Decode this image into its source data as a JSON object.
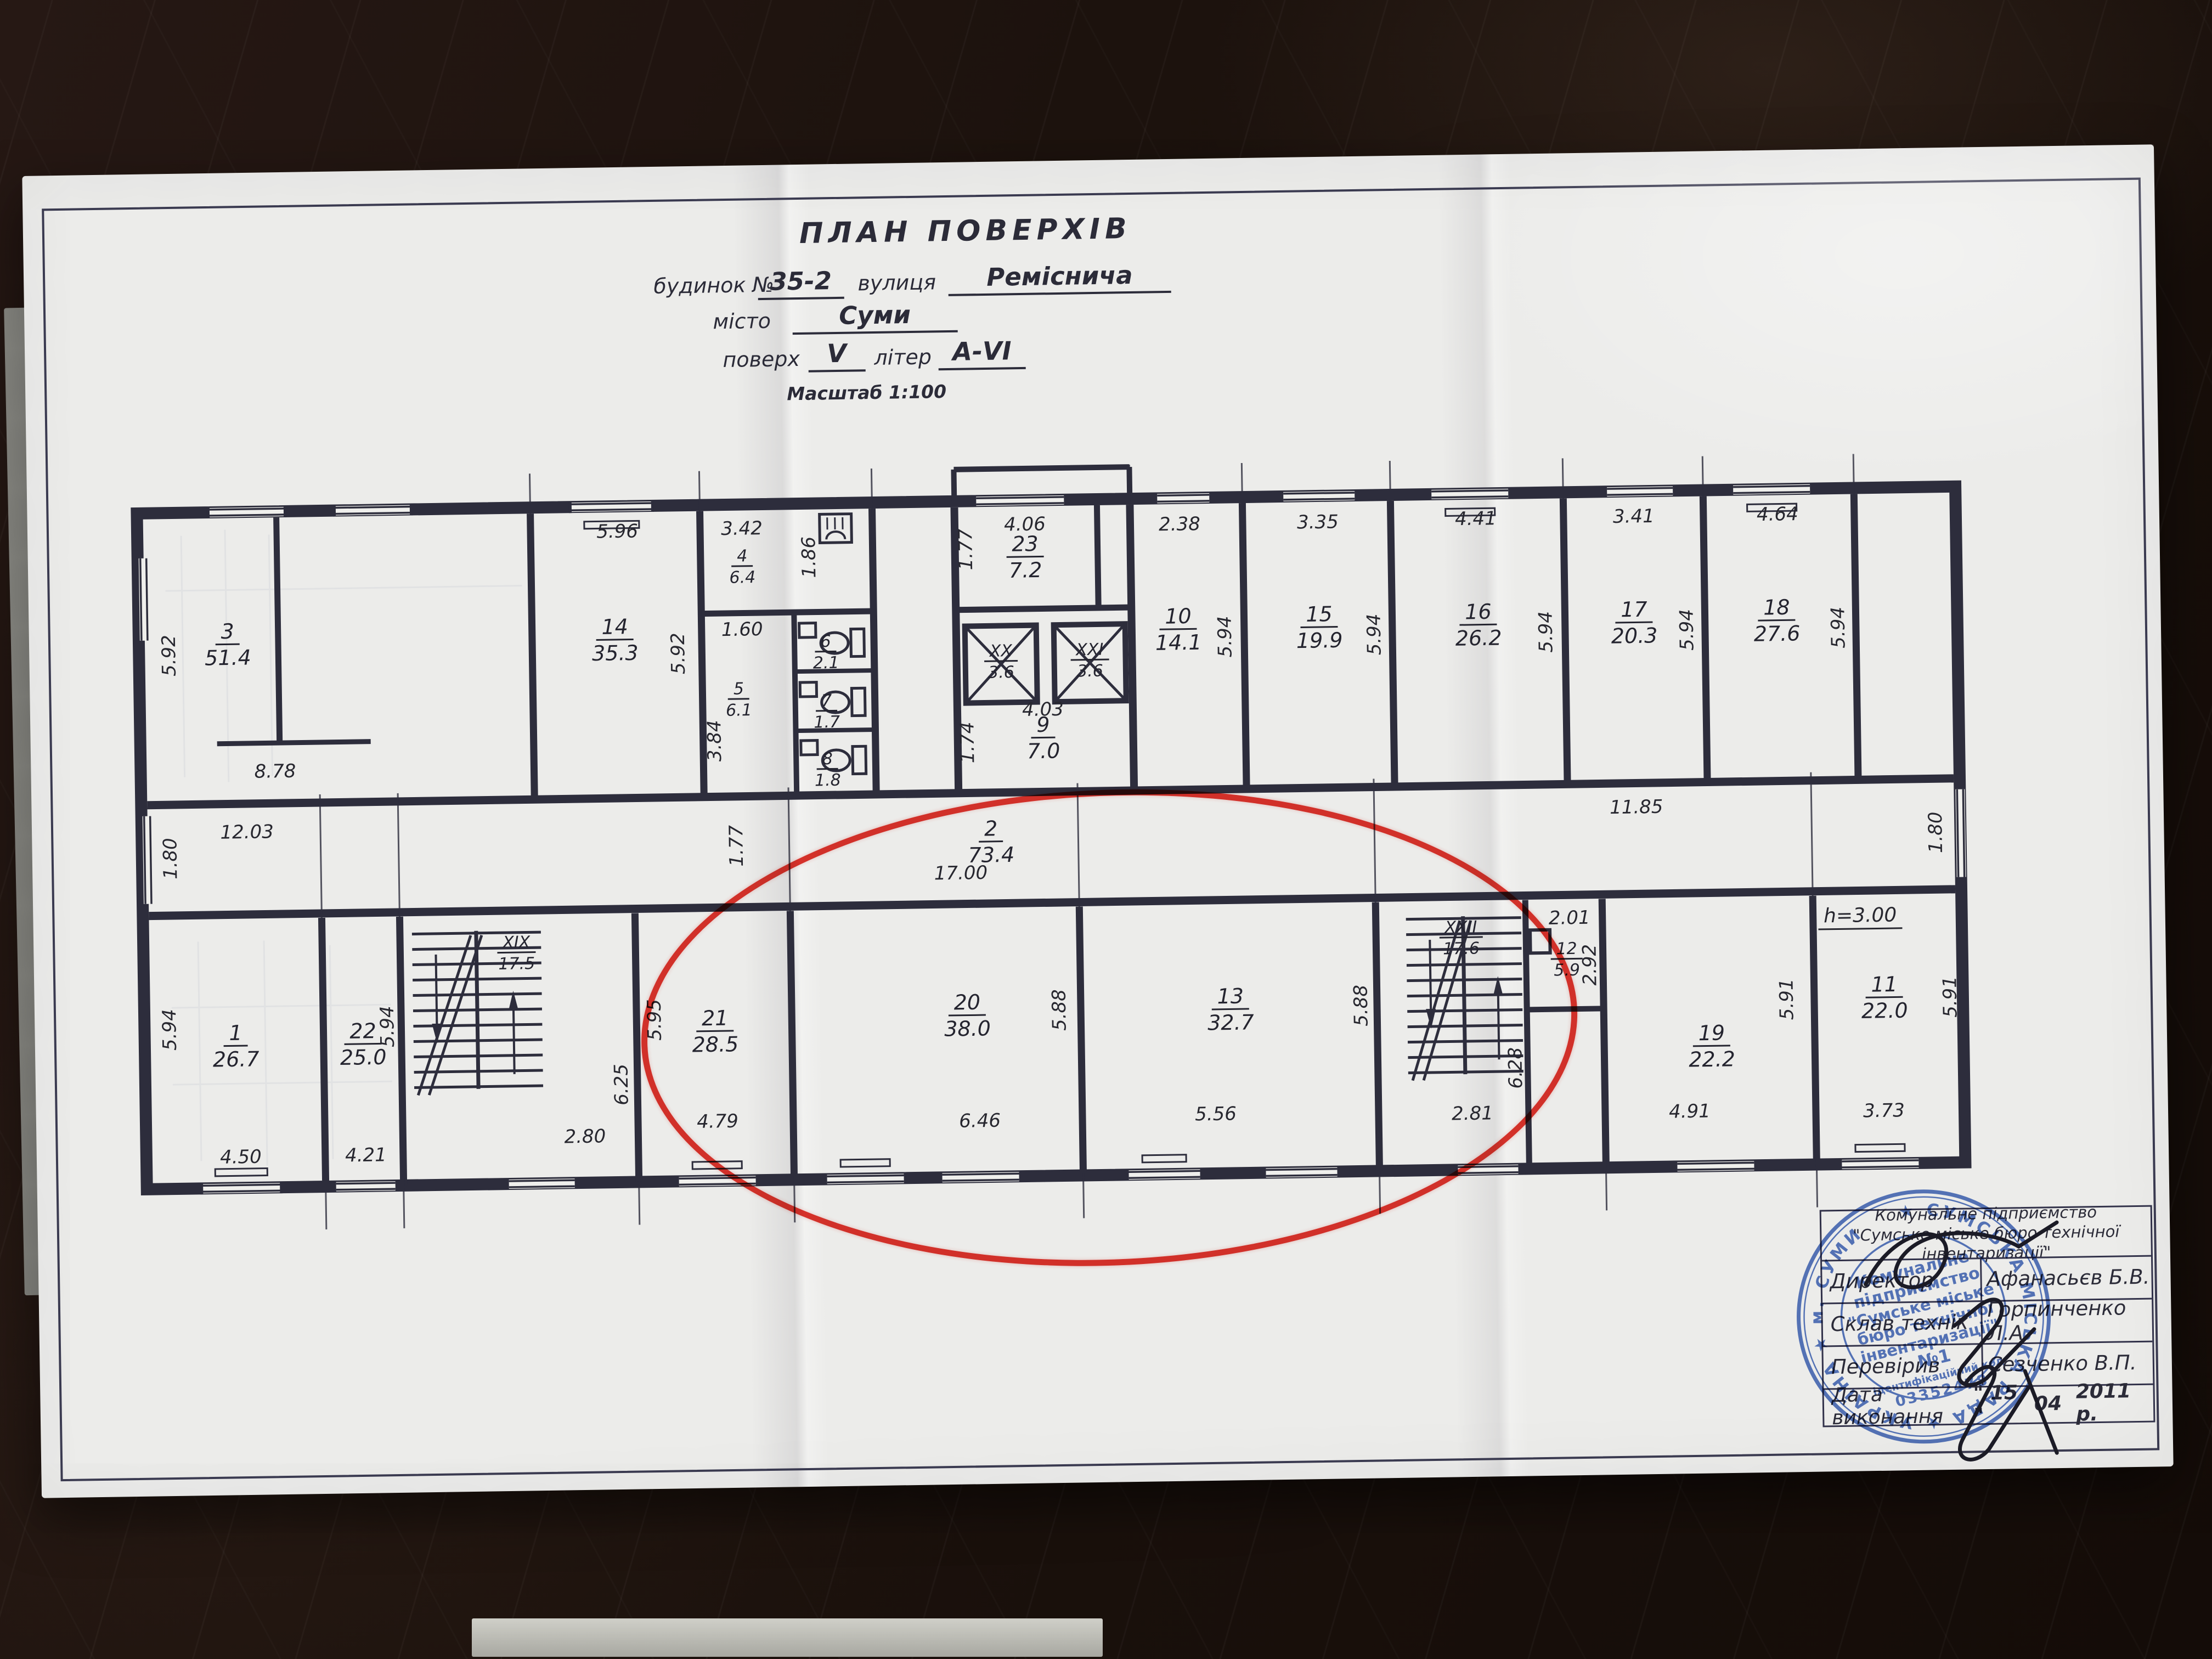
{
  "title_block": {
    "title": "ПЛАН ПОВЕРХІВ",
    "building_label": "будинок №",
    "building_value": "35-2",
    "street_label": "вулиця",
    "street_value": "Реміснича",
    "city_label": "місто",
    "city_value": "Суми",
    "floor_label": "поверх",
    "floor_value": "V",
    "letter_label": "літер",
    "letter_value": "А-VI",
    "scale_label": "Масштаб 1:100"
  },
  "plan": {
    "rooms": [
      {
        "num": "3",
        "area": "51.4"
      },
      {
        "num": "14",
        "area": "35.3"
      },
      {
        "num": "4",
        "area": "6.4"
      },
      {
        "num": "5",
        "area": "6.1"
      },
      {
        "num": "6",
        "area": "2.1"
      },
      {
        "num": "7",
        "area": "1.7"
      },
      {
        "num": "8",
        "area": "1.8"
      },
      {
        "num": "23",
        "area": "7.2"
      },
      {
        "num": "XX",
        "area": "3.6"
      },
      {
        "num": "XXI",
        "area": "3.6"
      },
      {
        "num": "9",
        "area": "7.0"
      },
      {
        "num": "10",
        "area": "14.1"
      },
      {
        "num": "15",
        "area": "19.9"
      },
      {
        "num": "16",
        "area": "26.2"
      },
      {
        "num": "17",
        "area": "20.3"
      },
      {
        "num": "18",
        "area": "27.6"
      },
      {
        "num": "2",
        "area": "73.4"
      },
      {
        "num": "1",
        "area": "26.7"
      },
      {
        "num": "22",
        "area": "25.0"
      },
      {
        "num": "XIX",
        "area": "17.5"
      },
      {
        "num": "21",
        "area": "28.5"
      },
      {
        "num": "20",
        "area": "38.0"
      },
      {
        "num": "13",
        "area": "32.7"
      },
      {
        "num": "XXII",
        "area": "17.6"
      },
      {
        "num": "12",
        "area": "5.9"
      },
      {
        "num": "19",
        "area": "22.2"
      },
      {
        "num": "11",
        "area": "22.0"
      }
    ],
    "dims": [
      "5.92",
      "8.78",
      "5.96",
      "5.92",
      "3.42",
      "1.86",
      "1.60",
      "3.84",
      "4.06",
      "1.77",
      "4.03",
      "1.74",
      "2.38",
      "5.94",
      "3.35",
      "5.94",
      "4.41",
      "5.94",
      "3.41",
      "5.94",
      "4.64",
      "5.94",
      "12.03",
      "1.80",
      "17.00",
      "1.77",
      "11.85",
      "1.80",
      "5.94",
      "4.50",
      "4.21",
      "5.94",
      "6.25",
      "2.80",
      "5.95",
      "4.79",
      "5.88",
      "6.46",
      "5.88",
      "5.56",
      "6.28",
      "2.81",
      "2.01",
      "2.92",
      "5.91",
      "4.91",
      "5.91",
      "3.73"
    ],
    "height_note": "h=3.00"
  },
  "stamp_table": {
    "company_line1": "Комунальне підприємство",
    "company_line2": "\"Сумське міське бюро технічної інвентаризації\"",
    "rows": [
      {
        "label": "Директор",
        "value": "Афанасьєв Б.В."
      },
      {
        "label": "Склав технік",
        "value": "Горпинченко Л.А."
      },
      {
        "label": "Перевірив",
        "value": "Сезченко В.П."
      }
    ],
    "date_label": "Дата виконання",
    "date_day": "\" 15 \"",
    "date_month": "04",
    "date_year": "2011 р."
  },
  "seal": {
    "ring_text": "★ СУМСЬКА МІСЬКА РАДА ★ УКРАЇНА ★ м. СУМИ",
    "line1": "Комунальне",
    "line2": "підприємство",
    "line3": "\"Сумське міське",
    "line4": "бюро технічної",
    "line5": "інвентаризації\"",
    "line6": "№1",
    "line7": "ідентифікаційний код",
    "code": "03352478"
  }
}
